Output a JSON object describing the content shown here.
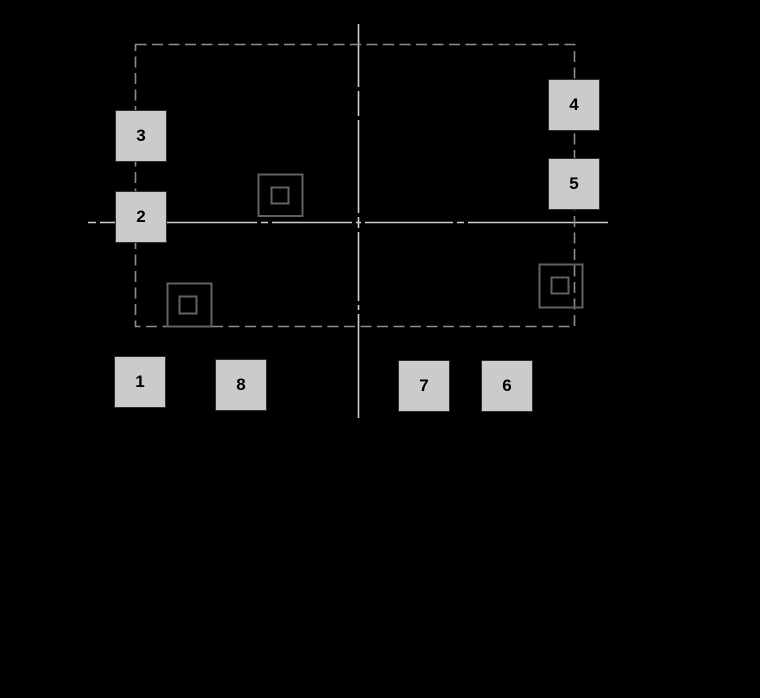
{
  "figure": {
    "type": "component-footprint-diagram",
    "background_color": "#000000"
  },
  "colors": {
    "centerline": "#cfcfcf",
    "courtyard_dashed": "#8c8c8c",
    "marker_outline": "#616161",
    "pad_fill": "#cbcbcb",
    "pad_border": "#2e2e2e",
    "pad_label": "#000000"
  },
  "pads": [
    {
      "label": "1"
    },
    {
      "label": "2"
    },
    {
      "label": "3"
    },
    {
      "label": "4"
    },
    {
      "label": "5"
    },
    {
      "label": "6"
    },
    {
      "label": "7"
    },
    {
      "label": "8"
    }
  ],
  "markers": {
    "count": 3,
    "style": "square-in-square"
  }
}
